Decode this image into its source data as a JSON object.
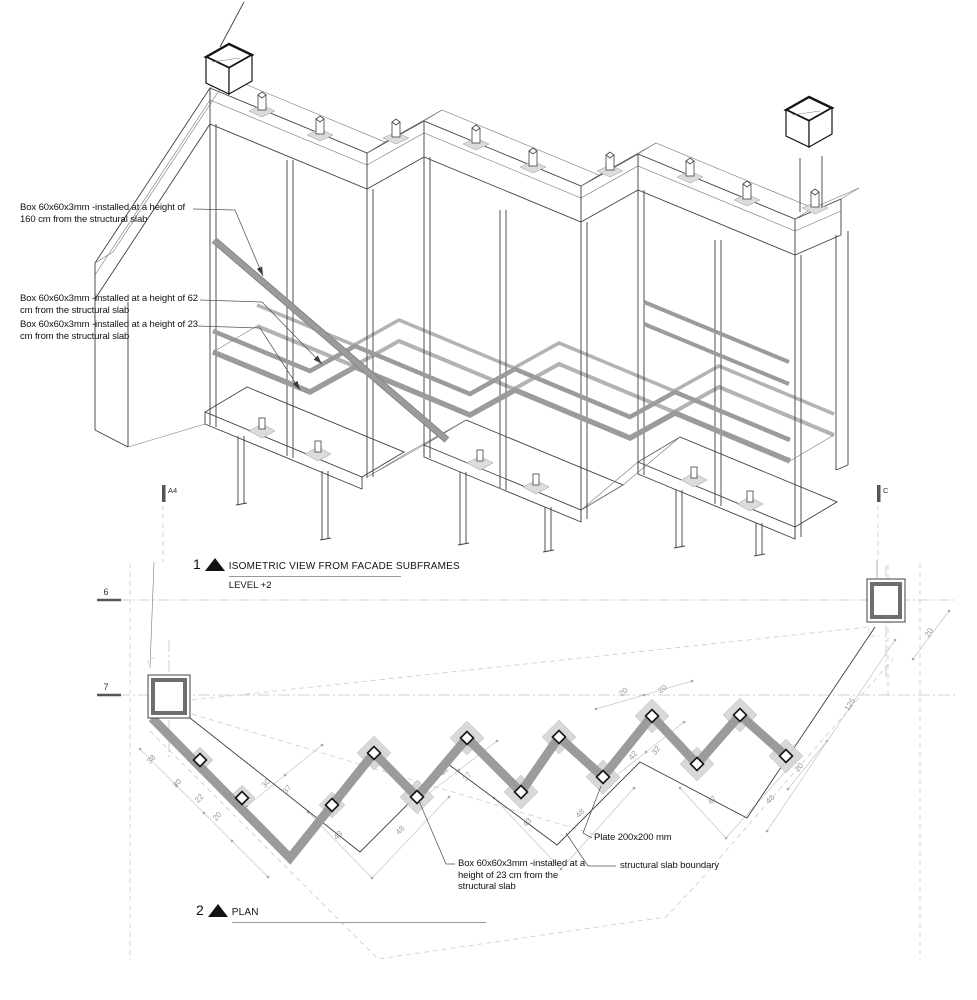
{
  "iso": {
    "title_num": "1",
    "title": "ISOMETRIC VIEW FROM FACADE SUBFRAMES",
    "subtitle": "LEVEL +2",
    "callouts": [
      {
        "l1": "Box 60x60x3mm -installed at a height of",
        "l2": "160 cm from the structural slab"
      },
      {
        "l1": "Box 60x60x3mm -installed at a height of 62",
        "l2": "cm from the structural slab"
      },
      {
        "l1": "Box 60x60x3mm -installed at a height of 23",
        "l2": "cm from the structural slab"
      }
    ]
  },
  "plan": {
    "title_num": "2",
    "title": "PLAN",
    "section_markers": {
      "a": "A4",
      "c": "C"
    },
    "grid": {
      "g6": "6",
      "g7": "7"
    },
    "callouts": {
      "plate": "Plate 200x200 mm",
      "box_l1": "Box 60x60x3mm -installed at a",
      "box_l2": "height of 23 cm from the",
      "box_l3": "structural slab",
      "slab": "structural slab boundary"
    },
    "dims": [
      {
        "v": "38"
      },
      {
        "v": "20"
      },
      {
        "v": "22"
      },
      {
        "v": "20"
      },
      {
        "v": "30"
      },
      {
        "v": "37"
      },
      {
        "v": "42"
      },
      {
        "v": "37"
      },
      {
        "v": "42"
      },
      {
        "v": "32"
      },
      {
        "v": "20"
      },
      {
        "v": "20"
      },
      {
        "v": "43"
      },
      {
        "v": "48"
      },
      {
        "v": "43"
      },
      {
        "v": "48"
      },
      {
        "v": "47"
      },
      {
        "v": "48"
      },
      {
        "v": "20"
      },
      {
        "v": "125"
      },
      {
        "v": "20"
      }
    ]
  },
  "colors": {
    "rail": "#9b9b9b",
    "plate": "#d5d5d5",
    "line": "#3f3f3f",
    "accent": "#121212"
  }
}
